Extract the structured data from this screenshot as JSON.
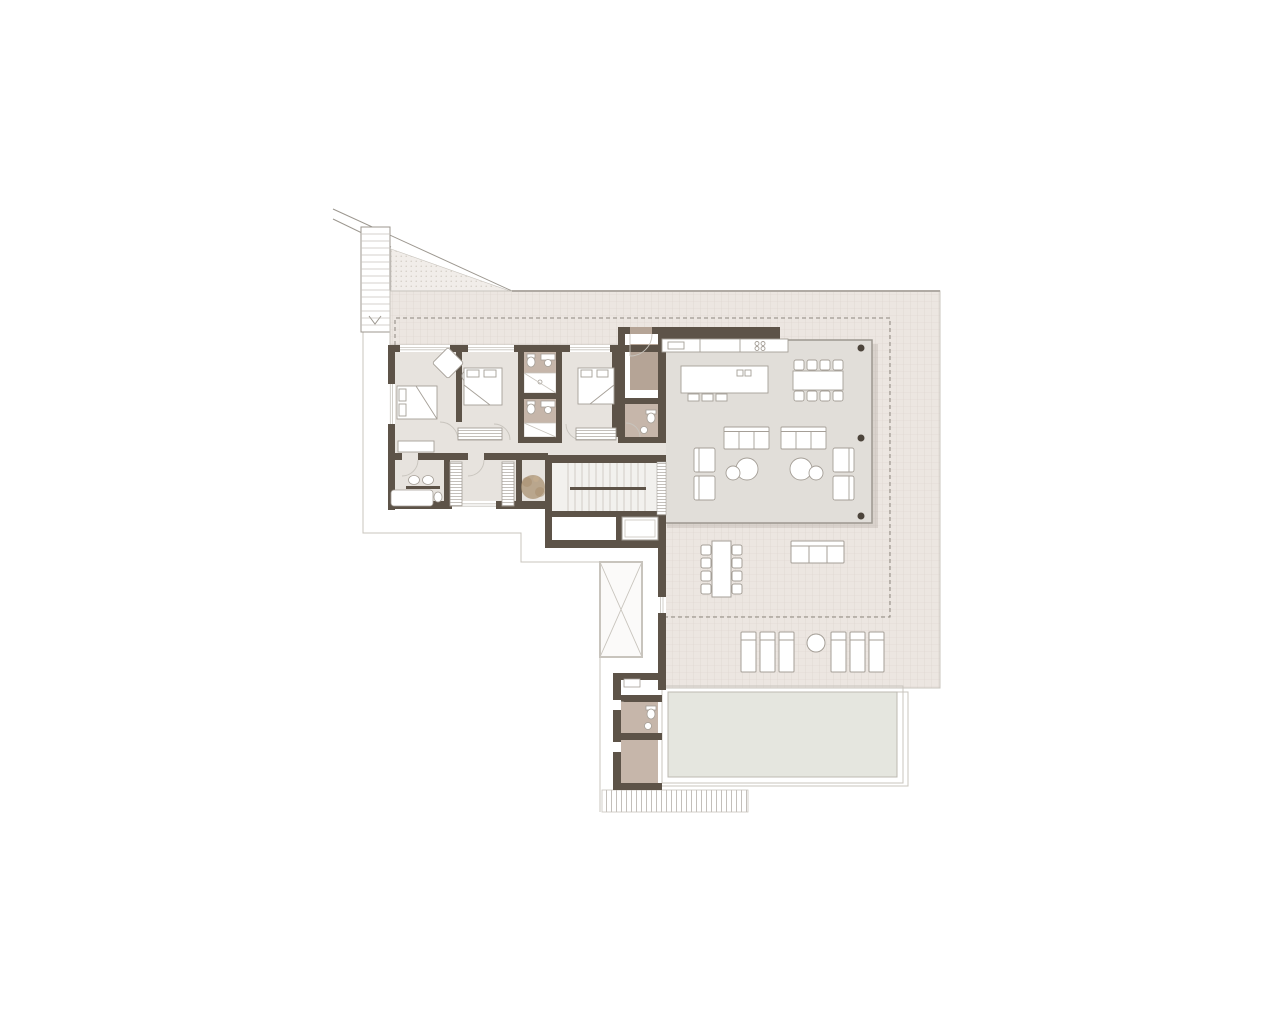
{
  "canvas": {
    "width": 1280,
    "height": 1024
  },
  "plan": {
    "type": "architectural-floor-plan",
    "visible_text": [],
    "rooms": [
      "master-bedroom",
      "bedroom-2",
      "bedroom-3",
      "bathroom-1",
      "bathroom-2",
      "master-bathroom",
      "walk-in-closet",
      "hallway",
      "entry-vestibule",
      "guest-wc",
      "kitchen",
      "living-dining-room",
      "staircase",
      "elevator",
      "storage",
      "terrace",
      "outdoor-dining-area",
      "sun-deck",
      "pool",
      "pool-bathroom",
      "pool-storage"
    ],
    "element_counts": {
      "beds": 3,
      "indoor_sofas": 2,
      "indoor_armchairs": 4,
      "coffee_table_groups": 2,
      "kitchen_island_stools": 3,
      "indoor_dining_chairs": 8,
      "outdoor_dining_chairs": 8,
      "outdoor_sofas": 1,
      "sun_loungers": 6,
      "columns": 3,
      "wardrobes": 4,
      "plants": 1,
      "skylights": 1,
      "exterior_stairs": 1,
      "interior_stairs": 1
    }
  },
  "colors": {
    "background": "#ffffff",
    "wall": "#5d5348",
    "floor": "#e7e3de",
    "livingFloor": "#e1ded9",
    "wetFloor": "#c6b6aa",
    "entryFloor": "#b5a496",
    "terrace": "#ece6e1",
    "terraceLine": "#dbd3cc",
    "stipple": "#f1ede9",
    "stippleDot": "#c6beb4",
    "pool": "#e5e6df",
    "poolEdge": "#bdb9b1",
    "line": "#9c978f",
    "lineLight": "#c8c4bd",
    "dash": "#8d877e",
    "column": "#4c443b",
    "furn": "#a59f97",
    "plant": "#aa9172",
    "hatch": "#aaa49c",
    "shadow": "rgba(90,80,70,0.13)",
    "skylight": "#fbfaf9",
    "white": "#ffffff"
  }
}
